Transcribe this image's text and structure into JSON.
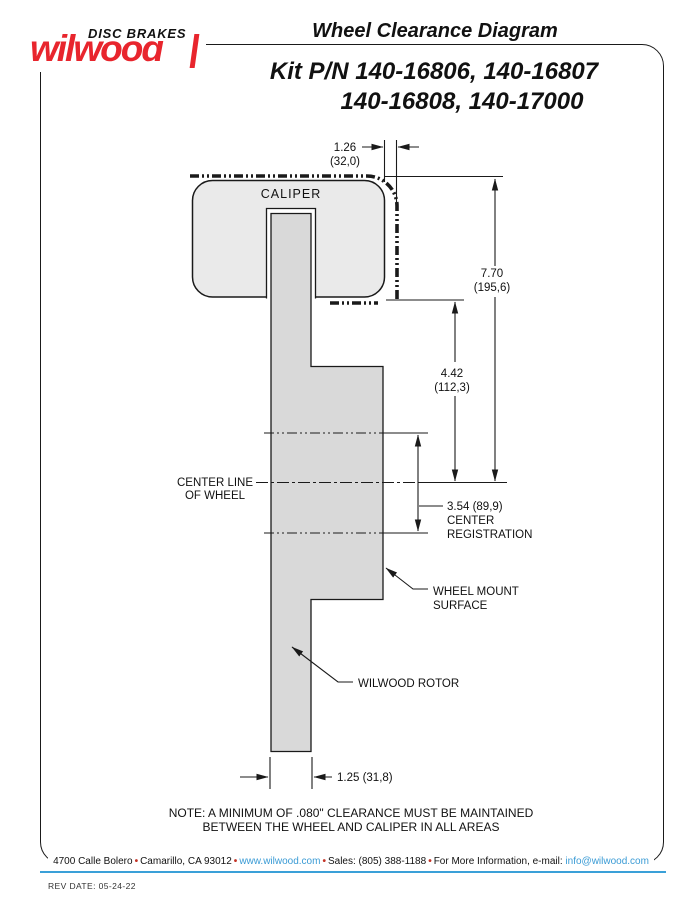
{
  "logo": {
    "tagline": "DISC BRAKES",
    "brand": "wilwood"
  },
  "header": {
    "title": "Wheel Clearance Diagram",
    "kit_line1": "Kit P/N 140-16806, 140-16807",
    "kit_line2": "140-16808, 140-17000"
  },
  "diagram": {
    "caliper_label": "CALIPER",
    "dim_top": {
      "in": "1.26",
      "mm": "(32,0)"
    },
    "dim_total": {
      "in": "7.70",
      "mm": "(195,6)"
    },
    "dim_mid": {
      "in": "4.42",
      "mm": "(112,3)"
    },
    "centerline": {
      "0": "CENTER LINE",
      "1": "OF WHEEL"
    },
    "registration": {
      "0": "3.54 (89,9)",
      "1": "CENTER",
      "2": "REGISTRATION"
    },
    "wheel_mount": {
      "0": "WHEEL MOUNT",
      "1": "SURFACE"
    },
    "rotor_label": "WILWOOD ROTOR",
    "dim_bottom": "1.25 (31,8)"
  },
  "note": {
    "line1": "NOTE: A MINIMUM OF .080\" CLEARANCE MUST BE MAINTAINED",
    "line2": "BETWEEN THE WHEEL AND CALIPER IN ALL AREAS"
  },
  "footer": {
    "segments": {
      "0": {
        "text": "4700 Calle Bolero"
      },
      "1": {
        "text": "•"
      },
      "2": {
        "text": "Camarillo, CA 93012"
      },
      "3": {
        "text": "•"
      },
      "4": {
        "text": "www.wilwood.com"
      },
      "5": {
        "text": "•"
      },
      "6": {
        "text": "Sales: (805) 388-1188"
      },
      "7": {
        "text": "•"
      },
      "8": {
        "text": "For More Information, e-mail:"
      },
      "9": {
        "text": "info@wilwood.com"
      }
    },
    "rev_date": "REV DATE:  05-24-22"
  },
  "colors": {
    "brand_red": "#e8252d",
    "link_blue": "#3a9bd5",
    "rule_blue": "#3aa0d8",
    "caliper_fill": "#eaeaea",
    "rotor_fill": "#d9d9d9",
    "line": "#1a1a1a"
  }
}
